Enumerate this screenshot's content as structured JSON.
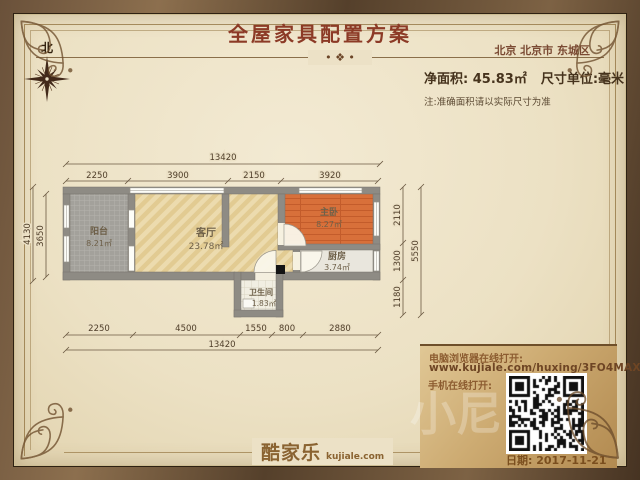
{
  "header": {
    "title": "全屋家具配置方案",
    "region": "北京 北京市 东城区",
    "net_area": "净面积: 45.83㎡",
    "unit": "尺寸单位:毫米",
    "note": "注:准确面积请以实际尺寸为准"
  },
  "icons": {
    "rule_ornament": "• ❖ •"
  },
  "compass": {
    "north": "北"
  },
  "plan": {
    "rooms": {
      "balcony": {
        "name": "阳台",
        "area": "8.21㎡"
      },
      "living": {
        "name": "客厅",
        "area": "23.78㎡"
      },
      "master": {
        "name": "主卧",
        "area": "8.27㎡"
      },
      "kitchen": {
        "name": "厨房",
        "area": "3.74㎡"
      },
      "bath": {
        "name": "卫生间",
        "area": "1.83㎡"
      }
    },
    "dims": {
      "top_total": "13420",
      "top_segments": [
        "2250",
        "3900",
        "2150",
        "3920"
      ],
      "bottom_segments": [
        "2250",
        "4500",
        "1550",
        "800",
        "2880"
      ],
      "bottom_total": "13420",
      "left_outer": "4130",
      "left_inner": "3650",
      "right_segments": [
        "2110",
        "1300",
        "1180"
      ],
      "right_total": "5550"
    }
  },
  "panel": {
    "pc_label": "电脑浏览器在线打开:",
    "url": "www.kujiale.com/huxing/3FO4MAXECRPD",
    "mobile_label": "手机在线打开:",
    "date": "日期: 2017-11-21"
  },
  "footer": {
    "logo": "酷家乐",
    "logo_domain": "kujiale.com"
  },
  "watermark": "小尼",
  "colors": {
    "wall": "#8e8b84",
    "bedroom_floor": "#d8703a",
    "title": "#8c3a26",
    "frame": "#5a4330",
    "paper": "#ece1c6"
  }
}
